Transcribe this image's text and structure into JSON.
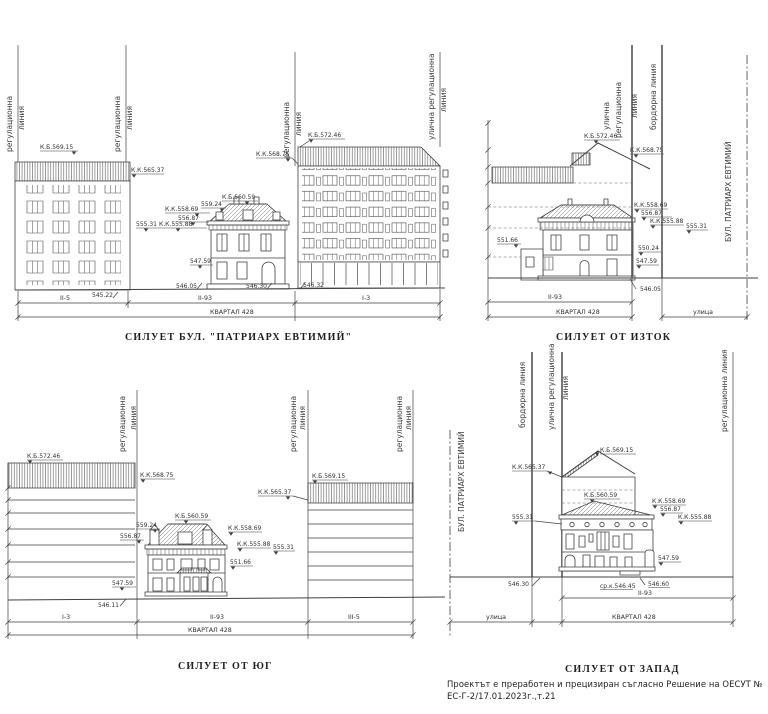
{
  "titles": {
    "p1": "СИЛУЕТ БУЛ. \"ПАТРИАРХ ЕВТИМИЙ\"",
    "p2": "СИЛУЕТ ОТ ИЗТОК",
    "p3": "СИЛУЕТ ОТ ЮГ",
    "p4": "СИЛУЕТ ОТ ЗАПАД"
  },
  "lines": {
    "reg": "регулационна",
    "linia": "линия",
    "street": "улична регулационна",
    "street1": "улична",
    "bord": "бордюрна линия",
    "regline": "регулационна линия",
    "blvd": "БУЛ. ПАТРИАРХ ЕВТИМИЙ"
  },
  "elev": {
    "kb572": "К.Б.572.46",
    "kk568": "К.К.568.75",
    "kb569": "К.Б.569.15",
    "kk565": "К.К.565.37",
    "kb560": "К.Б.560.59",
    "kk558": "К.К.558.69",
    "v559": "559.24",
    "v556": "556.87",
    "v555": "555.31",
    "kk555": "К.К.555.88",
    "v551": "551.66",
    "v550": "550.24",
    "v547": "547.59",
    "v54605": "546.05",
    "v54630": "546.30",
    "v54632": "546.32",
    "v54522": "545.22",
    "v54611": "546.11",
    "v54660": "546.60",
    "srk": "ср.к.546.45"
  },
  "dims": {
    "ii5": "II-5",
    "ii93": "II-93",
    "i3": "I-3",
    "iii5": "III-5",
    "kv": "КВАРТАЛ 428",
    "ul": "улица"
  },
  "note": {
    "l1": "Проектът е преработен и прецизиран съгласно Решение на ОЕСУТ №",
    "l2": "ЕС-Г-2/17.01.2023г.,т.21"
  }
}
